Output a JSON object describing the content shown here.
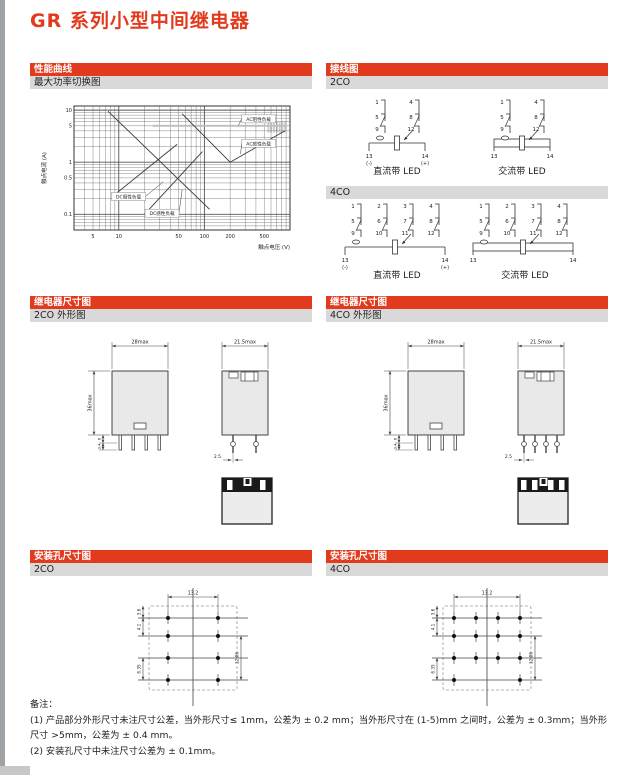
{
  "page": {
    "title": "GR 系列小型中间继电器"
  },
  "colors": {
    "accent": "#e23a1d",
    "bar_gray": "#d9d9d9",
    "drawing_fill": "#e9e9e9",
    "line": "#3a3a3a"
  },
  "sections": {
    "perf": {
      "header": "性能曲线",
      "sub": "最大功率切换图"
    },
    "wiring": {
      "header": "接线图",
      "sub_2co": "2CO",
      "sub_4co": "4CO",
      "dc_caption": "直流带 LED",
      "ac_caption": "交流带 LED",
      "poles_2co": [
        [
          "1",
          "5",
          "9"
        ],
        [
          "4",
          "8",
          "12"
        ]
      ],
      "poles_4co": [
        [
          "1",
          "5",
          "9"
        ],
        [
          "2",
          "6",
          "10"
        ],
        [
          "3",
          "7",
          "11"
        ],
        [
          "4",
          "8",
          "12"
        ]
      ],
      "coil_terms": [
        "13",
        "14"
      ],
      "dc_polarity": [
        "(-)",
        "(+)"
      ]
    },
    "outline": {
      "header": "继电器尺寸图",
      "sub_2co": "2CO 外形图",
      "sub_4co": "4CO 外形图",
      "front_width": "28max",
      "side_width": "21.5max",
      "height": "36max",
      "pin_length": "6",
      "pin_tip": "3.4",
      "pin_pitch": "2.5"
    },
    "holes": {
      "header": "安装孔尺寸图",
      "sub_2co": "2CO",
      "sub_4co": "4CO",
      "dim_span": "13.2",
      "dim_top_edge": "3.6",
      "dim_row_1_2": "4.1",
      "dim_row_3_4": "6.35",
      "dim_right": "12.06"
    },
    "notes": {
      "label": "备注：",
      "items": [
        "(1) 产品部分外形尺寸未注尺寸公差，当外形尺寸≤ 1mm，公差为 ± 0.2 mm；当外形尺寸在 (1-5)mm 之间时，公差为 ± 0.3mm；当外形尺寸 >5mm，公差为 ± 0.4 mm。",
        "(2) 安装孔尺寸中未注尺寸公差为 ± 0.1mm。"
      ]
    }
  },
  "chart_data": {
    "type": "line",
    "title": "最大功率切换图",
    "xlabel": "触点电压 (V)",
    "ylabel": "触点电流 (A)",
    "x_scale": "log",
    "y_scale": "log",
    "xlim": [
      3,
      1000
    ],
    "ylim": [
      0.05,
      12
    ],
    "x_ticks": [
      5,
      10,
      50,
      100,
      200,
      500
    ],
    "y_ticks": [
      10,
      5,
      1,
      0.5,
      0.1
    ],
    "grid": "log-minor",
    "legend_position": "inline-labels",
    "series": [
      {
        "name": "AC阻性负载",
        "color": "#bdbdbd",
        "width": 1.8,
        "points": [
          [
            25,
            5
          ],
          [
            920,
            5
          ]
        ]
      },
      {
        "name": "AC感性负载",
        "color": "#3a3a3a",
        "width": 0.9,
        "points": [
          [
            55,
            8.5
          ],
          [
            200,
            1
          ],
          [
            870,
            4
          ]
        ]
      },
      {
        "name": "DC阻性负载",
        "color": "#3a3a3a",
        "width": 0.9,
        "points": [
          [
            7.5,
            9.5
          ],
          [
            115,
            0.125
          ]
        ]
      },
      {
        "name": "DC感性负载",
        "color": "#3a3a3a",
        "width": 0.9,
        "points": [
          [
            9,
            0.24
          ],
          [
            48,
            2.2
          ]
        ]
      },
      {
        "name": "",
        "color": "#3a3a3a",
        "width": 0.9,
        "points": [
          [
            20,
            0.1
          ],
          [
            95,
            1.6
          ]
        ]
      }
    ],
    "labels": [
      {
        "text": "AC阻性负载",
        "x": 430,
        "y": 6.8,
        "leader": [
          250,
          5.1
        ]
      },
      {
        "text": "AC感性负载",
        "x": 430,
        "y": 2.3,
        "leader": [
          265,
          1.45
        ]
      },
      {
        "text": "DC阻性负载",
        "x": 13,
        "y": 0.22,
        "leader": [
          33,
          0.42
        ]
      },
      {
        "text": "DC感性负载",
        "x": 32,
        "y": 0.105,
        "leader": [
          55,
          0.3
        ]
      }
    ],
    "hatch_region": {
      "x": [
        560,
        880
      ],
      "y": [
        3.7,
        6.1
      ]
    }
  }
}
